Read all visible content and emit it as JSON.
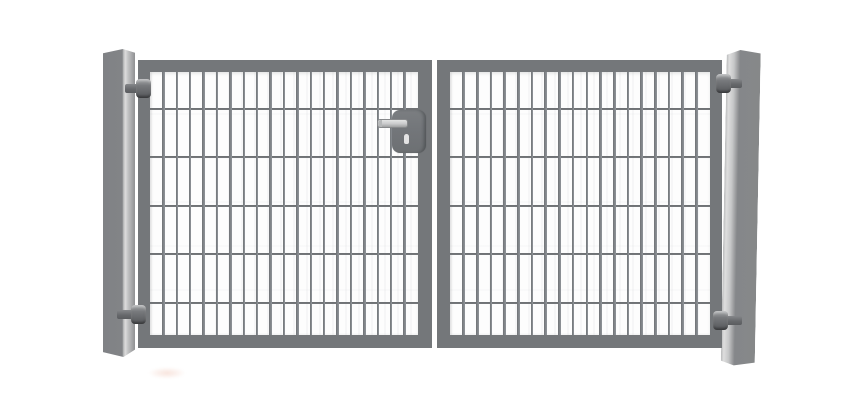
{
  "scene": {
    "subject": "double-wing-metal-mesh-gate",
    "background_color": "#ffffff",
    "parts_count": {
      "posts": 2,
      "wings": 2,
      "hinges": 4,
      "locks": 1
    }
  },
  "colors": {
    "frame_gray": "#74777a",
    "mesh_bar_gray": "#7f8387",
    "mesh_wire_gray": "#6c6f72",
    "post_front_gray": "#85878a",
    "post_highlight": "#dcdcdc",
    "lock_plate_gray": "#73767a",
    "handle_silver": "#c9cacb",
    "hinge_dark_gray": "#5a5c5f",
    "watermark_pink": "#f2cdc0"
  },
  "mesh": {
    "bar_spacing": 13.4,
    "bar_width": 2.6,
    "wire_height": 2.4,
    "wire_offsets": [
      35.5,
      84,
      132.5,
      181,
      229.5
    ]
  }
}
